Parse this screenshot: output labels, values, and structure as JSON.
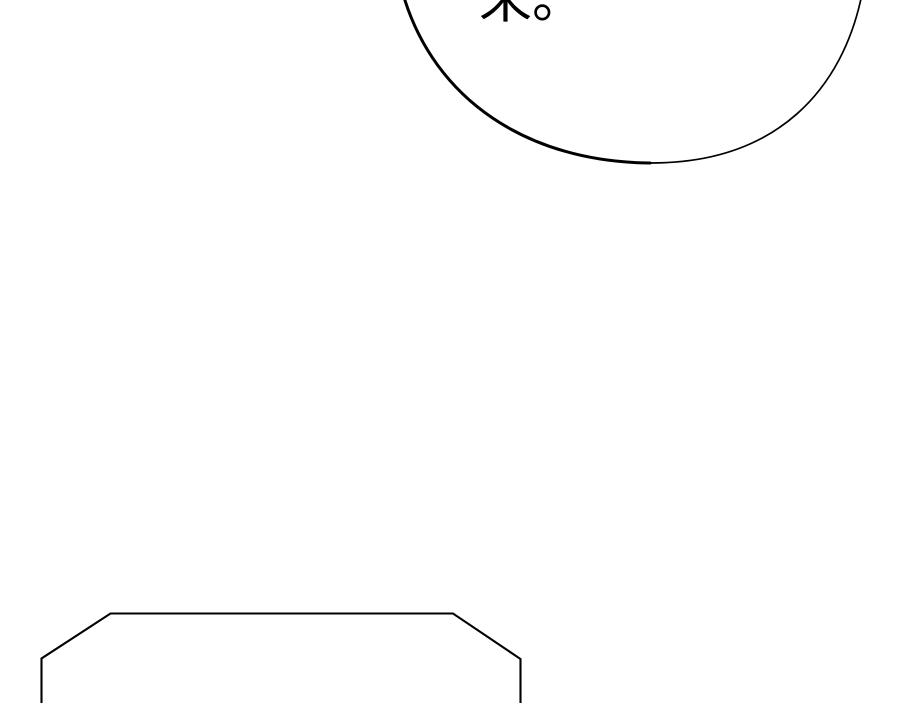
{
  "panel": {
    "type": "comic-strip-segment",
    "dialogue_fragment": "来。",
    "background_color": "#ffffff",
    "line_color": "#000000",
    "shapes": [
      "top-speech-bubble-ellipse-partial",
      "bottom-speech-bubble-octagon-partial"
    ]
  }
}
